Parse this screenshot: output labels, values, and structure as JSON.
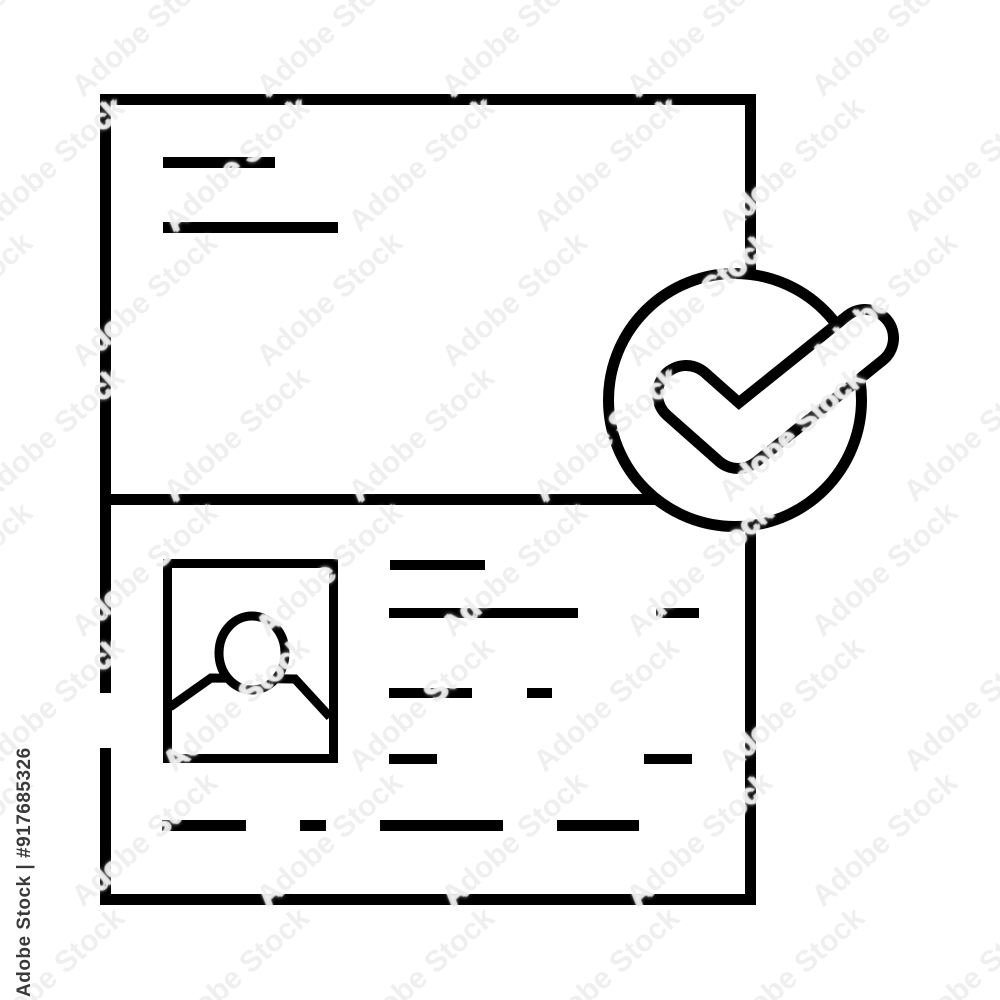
{
  "image": {
    "background_color": "#ffffff",
    "line_color": "#000000",
    "subject": "id-document-verified-check-line-icon"
  },
  "watermark": {
    "vertical_label": "Adobe Stock | #917685326",
    "tile_text": "Adobe Stock",
    "vertical_label_color": "#3a3a3a"
  },
  "icon_parts": {
    "document": "document-outline",
    "title": "title-placeholder-lines",
    "divider": "section-divider",
    "photo": "photo-frame-with-person",
    "details": "detail-placeholder-lines",
    "badge": "verified-check-circle"
  }
}
